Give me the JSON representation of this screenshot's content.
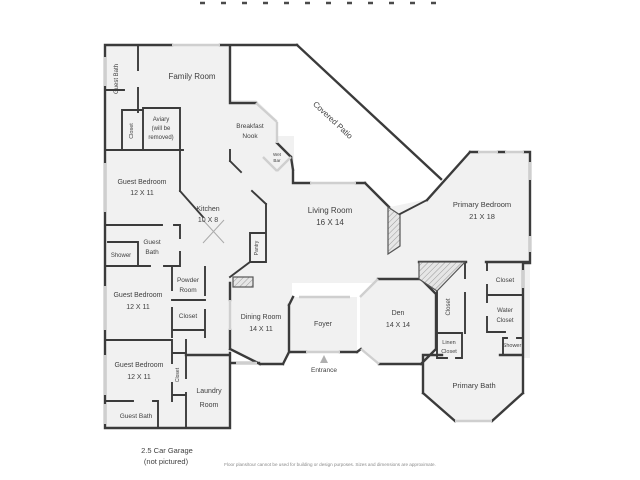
{
  "disclaimer": "Floor plans/tour cannot be used for building or design purposes. Sizes and dimensions are approximate.",
  "garage_note": {
    "line1": "2.5 Car Garage",
    "line2": "(not pictured)"
  },
  "colors": {
    "wall": "#3b3b3b",
    "room_fill": "#f1f1f1",
    "window": "#cfcfcf",
    "text": "#3f3f3f"
  },
  "rooms": {
    "family_room": {
      "label": "Family Room"
    },
    "guest_bath_1": {
      "label": "Guest Bath"
    },
    "closet_1": {
      "label": "Closet"
    },
    "aviary": {
      "line1": "Aviary",
      "line2": "(will be",
      "line3": "removed)"
    },
    "breakfast_nook": {
      "line1": "Breakfast",
      "line2": "Nook"
    },
    "wet_bar": {
      "line1": "Wet",
      "line2": "Bar"
    },
    "covered_patio": {
      "label": "Covered Patio"
    },
    "guest_bedroom_1": {
      "label": "Guest Bedroom",
      "dims": "12 X 11"
    },
    "kitchen": {
      "label": "Kitchen",
      "dims": "10 X 8"
    },
    "guest_bath_2": {
      "line1": "Guest",
      "line2": "Bath"
    },
    "shower_1": {
      "label": "Shower"
    },
    "pantry": {
      "label": "Pantry"
    },
    "powder_room": {
      "line1": "Powder",
      "line2": "Room"
    },
    "closet_2": {
      "label": "Closet"
    },
    "guest_bedroom_2": {
      "label": "Guest Bedroom",
      "dims": "12 X 11"
    },
    "living_room": {
      "label": "Living Room",
      "dims": "16 X 14"
    },
    "primary_bedroom": {
      "label": "Primary Bedroom",
      "dims": "21 X 18"
    },
    "dining_room": {
      "label": "Dining Room",
      "dims": "14 X 11"
    },
    "foyer": {
      "label": "Foyer"
    },
    "den": {
      "label": "Den",
      "dims": "14 X 14"
    },
    "entrance": {
      "label": "Entrance"
    },
    "guest_bedroom_3": {
      "label": "Guest Bedroom",
      "dims": "12 X 11"
    },
    "closet_3": {
      "label": "Closet"
    },
    "laundry_room": {
      "line1": "Laundry",
      "line2": "Room"
    },
    "guest_bath_3": {
      "label": "Guest Bath"
    },
    "closet_4": {
      "label": "Closet"
    },
    "closet_5": {
      "label": "Closet"
    },
    "water_closet": {
      "line1": "Water",
      "line2": "Closet"
    },
    "linen_closet": {
      "line1": "Linen",
      "line2": "Closet"
    },
    "shower_2": {
      "label": "Shower"
    },
    "primary_bath": {
      "label": "Primary Bath"
    }
  }
}
